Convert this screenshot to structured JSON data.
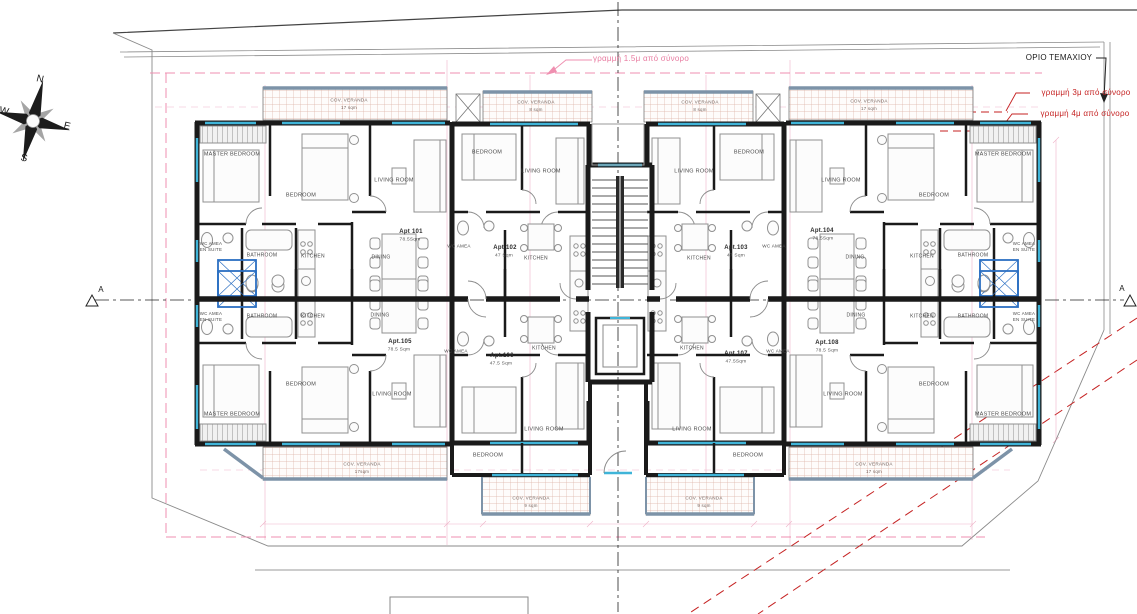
{
  "drawing_type": "architectural-floor-plan",
  "colors": {
    "wall": "#1a1a1a",
    "window": "#3fb4d8",
    "veranda_rail": "#7d93a8",
    "setback_1_5m": "#ef8fb0",
    "setback_red": "#c52222",
    "boundary_gray": "#8a8a8a",
    "construction_pink": "#e06a94"
  },
  "annotations": {
    "parcel_boundary_label": "ΟΡΙΟ ΤΕΜΑΧΙΟΥ",
    "setback_1_5m_label": "γραμμή 1.5μ από σύνορο",
    "setback_3m_label": "γραμμή 3μ από σύνορο",
    "setback_4m_label": "γραμμή 4μ από σύνορο",
    "section_marker": "A"
  },
  "compass": {
    "north": "N",
    "east": "E",
    "south": "S",
    "west": "W"
  },
  "apartments": [
    {
      "id": "Apt 101",
      "area": "78.5Sqm"
    },
    {
      "id": "Apt.102",
      "area": "47 Sqm"
    },
    {
      "id": "Apt.103",
      "area": "47 Sqm"
    },
    {
      "id": "Apt.104",
      "area": "78.5Sqm"
    },
    {
      "id": "Apt.105",
      "area": "78.5 Sqm"
    },
    {
      "id": "Apt.106",
      "area": "47.5 Sqm"
    },
    {
      "id": "Apt.107",
      "area": "47.5Sqm"
    },
    {
      "id": "Apt.108",
      "area": "78.5 Sqm"
    }
  ],
  "labels": [
    {
      "t": "MASTER BEDROOM",
      "x": 232,
      "y": 155,
      "s": 5.5,
      "c": "room",
      "n": "room-label-master-bedroom"
    },
    {
      "t": "BEDROOM",
      "x": 301,
      "y": 196,
      "s": 5.5,
      "c": "room",
      "n": "room-label-bedroom"
    },
    {
      "t": "LIVING ROOM",
      "x": 394,
      "y": 181,
      "s": 5.5,
      "c": "room",
      "n": "room-label-living-room"
    },
    {
      "t": "BATHROOM",
      "x": 262,
      "y": 256,
      "s": 5,
      "c": "room",
      "n": "room-label-bathroom"
    },
    {
      "t": "KITCHEN",
      "x": 313,
      "y": 257,
      "s": 5,
      "c": "room",
      "n": "room-label-kitchen"
    },
    {
      "t": "DINING",
      "x": 381,
      "y": 258,
      "s": 5,
      "c": "room",
      "n": "room-label-dining"
    },
    {
      "t": "WC AMEA",
      "x": 211,
      "y": 244,
      "s": 4.4,
      "c": "room",
      "n": "room-label-wc-amea"
    },
    {
      "t": "EN SUITE",
      "x": 211,
      "y": 250,
      "s": 4.4,
      "c": "room",
      "n": "room-label-en-suite"
    },
    {
      "t": "BEDROOM",
      "x": 487,
      "y": 153,
      "s": 5.5,
      "c": "room",
      "n": "room-label-bedroom"
    },
    {
      "t": "LIVING ROOM",
      "x": 541,
      "y": 172,
      "s": 5.5,
      "c": "room",
      "n": "room-label-living-room"
    },
    {
      "t": "WC AMEA",
      "x": 459,
      "y": 247,
      "s": 4.6,
      "c": "room",
      "n": "room-label-wc-amea"
    },
    {
      "t": "KITCHEN",
      "x": 536,
      "y": 259,
      "s": 5,
      "c": "room",
      "n": "room-label-kitchen"
    },
    {
      "t": "LIVING ROOM",
      "x": 694,
      "y": 172,
      "s": 5.5,
      "c": "room",
      "n": "room-label-living-room"
    },
    {
      "t": "BEDROOM",
      "x": 749,
      "y": 153,
      "s": 5.5,
      "c": "room",
      "n": "room-label-bedroom"
    },
    {
      "t": "WC AMEA",
      "x": 774,
      "y": 247,
      "s": 4.6,
      "c": "room",
      "n": "room-label-wc-amea"
    },
    {
      "t": "KITCHEN",
      "x": 699,
      "y": 259,
      "s": 5,
      "c": "room",
      "n": "room-label-kitchen"
    },
    {
      "t": "DINING",
      "x": 855,
      "y": 258,
      "s": 5,
      "c": "room",
      "n": "room-label-dining"
    },
    {
      "t": "KITCHEN",
      "x": 922,
      "y": 257,
      "s": 5,
      "c": "room",
      "n": "room-label-kitchen"
    },
    {
      "t": "BATHROOM",
      "x": 973,
      "y": 256,
      "s": 5,
      "c": "room",
      "n": "room-label-bathroom"
    },
    {
      "t": "WC AMEA",
      "x": 1024,
      "y": 244,
      "s": 4.4,
      "c": "room",
      "n": "room-label-wc-amea"
    },
    {
      "t": "EN SUITE",
      "x": 1024,
      "y": 250,
      "s": 4.4,
      "c": "room",
      "n": "room-label-en-suite"
    },
    {
      "t": "BEDROOM",
      "x": 934,
      "y": 196,
      "s": 5.5,
      "c": "room",
      "n": "room-label-bedroom"
    },
    {
      "t": "LIVING ROOM",
      "x": 841,
      "y": 181,
      "s": 5.5,
      "c": "room",
      "n": "room-label-living-room"
    },
    {
      "t": "MASTER BEDROOM",
      "x": 1003,
      "y": 155,
      "s": 5.5,
      "c": "room",
      "n": "room-label-master-bedroom"
    },
    {
      "t": "BATHROOM",
      "x": 262,
      "y": 317,
      "s": 5,
      "c": "room",
      "n": "room-label-bathroom"
    },
    {
      "t": "KITCHEN",
      "x": 313,
      "y": 317,
      "s": 5,
      "c": "room",
      "n": "room-label-kitchen"
    },
    {
      "t": "DINING",
      "x": 380,
      "y": 316,
      "s": 5,
      "c": "room",
      "n": "room-label-dining"
    },
    {
      "t": "WC AMEA",
      "x": 211,
      "y": 314,
      "s": 4.4,
      "c": "room",
      "n": "room-label-wc-amea"
    },
    {
      "t": "EN SUITE",
      "x": 211,
      "y": 320,
      "s": 4.4,
      "c": "room",
      "n": "room-label-en-suite"
    },
    {
      "t": "BEDROOM",
      "x": 301,
      "y": 385,
      "s": 5.5,
      "c": "room",
      "n": "room-label-bedroom"
    },
    {
      "t": "MASTER BEDROOM",
      "x": 232,
      "y": 415,
      "s": 5.5,
      "c": "room",
      "n": "room-label-master-bedroom"
    },
    {
      "t": "LIVING ROOM",
      "x": 392,
      "y": 395,
      "s": 5.5,
      "c": "room",
      "n": "room-label-living-room"
    },
    {
      "t": "WC AMEA",
      "x": 456,
      "y": 352,
      "s": 4.6,
      "c": "room",
      "n": "room-label-wc-amea"
    },
    {
      "t": "KITCHEN",
      "x": 544,
      "y": 349,
      "s": 5,
      "c": "room",
      "n": "room-label-kitchen"
    },
    {
      "t": "BEDROOM",
      "x": 488,
      "y": 456,
      "s": 5.5,
      "c": "room",
      "n": "room-label-bedroom"
    },
    {
      "t": "LIVING ROOM",
      "x": 544,
      "y": 430,
      "s": 5.5,
      "c": "room",
      "n": "room-label-living-room"
    },
    {
      "t": "KITCHEN",
      "x": 692,
      "y": 349,
      "s": 5,
      "c": "room",
      "n": "room-label-kitchen"
    },
    {
      "t": "WC AMEA",
      "x": 778,
      "y": 352,
      "s": 4.6,
      "c": "room",
      "n": "room-label-wc-amea"
    },
    {
      "t": "LIVING ROOM",
      "x": 692,
      "y": 430,
      "s": 5.5,
      "c": "room",
      "n": "room-label-living-room"
    },
    {
      "t": "BEDROOM",
      "x": 748,
      "y": 456,
      "s": 5.5,
      "c": "room",
      "n": "room-label-bedroom"
    },
    {
      "t": "DINING",
      "x": 856,
      "y": 316,
      "s": 5,
      "c": "room",
      "n": "room-label-dining"
    },
    {
      "t": "KITCHEN",
      "x": 922,
      "y": 317,
      "s": 5,
      "c": "room",
      "n": "room-label-kitchen"
    },
    {
      "t": "BATHROOM",
      "x": 973,
      "y": 317,
      "s": 5,
      "c": "room",
      "n": "room-label-bathroom"
    },
    {
      "t": "WC AMEA",
      "x": 1024,
      "y": 314,
      "s": 4.4,
      "c": "room",
      "n": "room-label-wc-amea"
    },
    {
      "t": "EN SUITE",
      "x": 1024,
      "y": 320,
      "s": 4.4,
      "c": "room",
      "n": "room-label-en-suite"
    },
    {
      "t": "BEDROOM",
      "x": 934,
      "y": 385,
      "s": 5.5,
      "c": "room",
      "n": "room-label-bedroom"
    },
    {
      "t": "MASTER BEDROOM",
      "x": 1003,
      "y": 415,
      "s": 5.5,
      "c": "room",
      "n": "room-label-master-bedroom"
    },
    {
      "t": "LIVING ROOM",
      "x": 843,
      "y": 395,
      "s": 5.5,
      "c": "room",
      "n": "room-label-living-room"
    },
    {
      "t": "Apt 101",
      "x": 411,
      "y": 232,
      "s": 6,
      "c": "apt",
      "n": "apt-id-101"
    },
    {
      "t": "78.5Sqm",
      "x": 410,
      "y": 241,
      "s": 4.8,
      "c": "area",
      "n": "apt-area-101"
    },
    {
      "t": "Apt.102",
      "x": 505,
      "y": 248,
      "s": 6,
      "c": "apt",
      "n": "apt-id-102"
    },
    {
      "t": "47 Sqm",
      "x": 504,
      "y": 257,
      "s": 4.8,
      "c": "area",
      "n": "apt-area-102"
    },
    {
      "t": "Apt.103",
      "x": 736,
      "y": 248,
      "s": 6,
      "c": "apt",
      "n": "apt-id-103"
    },
    {
      "t": "47 Sqm",
      "x": 736,
      "y": 257,
      "s": 4.8,
      "c": "area",
      "n": "apt-area-103"
    },
    {
      "t": "Apt.104",
      "x": 822,
      "y": 231,
      "s": 6,
      "c": "apt",
      "n": "apt-id-104"
    },
    {
      "t": "78.5Sqm",
      "x": 823,
      "y": 240,
      "s": 4.8,
      "c": "area",
      "n": "apt-area-104"
    },
    {
      "t": "Apt.105",
      "x": 400,
      "y": 342,
      "s": 6,
      "c": "apt",
      "n": "apt-id-105"
    },
    {
      "t": "78.5 Sqm",
      "x": 399,
      "y": 351,
      "s": 4.8,
      "c": "area",
      "n": "apt-area-105"
    },
    {
      "t": "Apt.106",
      "x": 502,
      "y": 356,
      "s": 6,
      "c": "apt",
      "n": "apt-id-106"
    },
    {
      "t": "47.5 Sqm",
      "x": 501,
      "y": 365,
      "s": 4.8,
      "c": "area",
      "n": "apt-area-106"
    },
    {
      "t": "Apt.107",
      "x": 736,
      "y": 354,
      "s": 6,
      "c": "apt",
      "n": "apt-id-107"
    },
    {
      "t": "47.5Sqm",
      "x": 736,
      "y": 363,
      "s": 4.8,
      "c": "area",
      "n": "apt-area-107"
    },
    {
      "t": "Apt.108",
      "x": 827,
      "y": 343,
      "s": 6,
      "c": "apt",
      "n": "apt-id-108"
    },
    {
      "t": "78.5 Sqm",
      "x": 827,
      "y": 352,
      "s": 4.8,
      "c": "area",
      "n": "apt-area-108"
    },
    {
      "t": "COV. VERANDA",
      "x": 349,
      "y": 101,
      "s": 4.6,
      "c": "ver",
      "n": "veranda-label"
    },
    {
      "t": "17 sqm",
      "x": 349,
      "y": 108,
      "s": 4.4,
      "c": "ver",
      "n": "veranda-area"
    },
    {
      "t": "COV. VERANDA",
      "x": 536,
      "y": 103,
      "s": 4.6,
      "c": "ver",
      "n": "veranda-label"
    },
    {
      "t": "8 sqm",
      "x": 536,
      "y": 110,
      "s": 4.4,
      "c": "ver",
      "n": "veranda-area"
    },
    {
      "t": "COV. VERANDA",
      "x": 700,
      "y": 103,
      "s": 4.6,
      "c": "ver",
      "n": "veranda-label"
    },
    {
      "t": "8 sqm",
      "x": 700,
      "y": 110,
      "s": 4.4,
      "c": "ver",
      "n": "veranda-area"
    },
    {
      "t": "COV. VERANDA",
      "x": 869,
      "y": 102,
      "s": 4.6,
      "c": "ver",
      "n": "veranda-label"
    },
    {
      "t": "17 sqm",
      "x": 869,
      "y": 109,
      "s": 4.4,
      "c": "ver",
      "n": "veranda-area"
    },
    {
      "t": "COV. VERANDA",
      "x": 362,
      "y": 465,
      "s": 4.6,
      "c": "ver",
      "n": "veranda-label"
    },
    {
      "t": "17sqm",
      "x": 362,
      "y": 472,
      "s": 4.4,
      "c": "ver",
      "n": "veranda-area"
    },
    {
      "t": "COV. VERANDA",
      "x": 531,
      "y": 499,
      "s": 4.6,
      "c": "ver",
      "n": "veranda-label"
    },
    {
      "t": "9 sqm",
      "x": 531,
      "y": 506,
      "s": 4.4,
      "c": "ver",
      "n": "veranda-area"
    },
    {
      "t": "COV. VERANDA",
      "x": 704,
      "y": 499,
      "s": 4.6,
      "c": "ver",
      "n": "veranda-label"
    },
    {
      "t": "9 sqm",
      "x": 704,
      "y": 506,
      "s": 4.4,
      "c": "ver",
      "n": "veranda-area"
    },
    {
      "t": "COV. VERANDA",
      "x": 874,
      "y": 465,
      "s": 4.6,
      "c": "ver",
      "n": "veranda-label"
    },
    {
      "t": "17 sqm",
      "x": 874,
      "y": 472,
      "s": 4.4,
      "c": "ver",
      "n": "veranda-area"
    },
    {
      "t": "ΟΡΙΟ ΤΕΜΑΧΙΟΥ",
      "x": 1059,
      "y": 58,
      "s": 8,
      "c": "blk",
      "n": "parcel-boundary-label"
    },
    {
      "t": "γραμμή 1.5μ από σύνορο",
      "x": 641,
      "y": 59,
      "s": 8,
      "c": "pink",
      "n": "setback-1-5m-label"
    },
    {
      "t": "γραμμή 3μ από σύνορο",
      "x": 1086,
      "y": 93,
      "s": 8,
      "c": "red",
      "n": "setback-3m-label"
    },
    {
      "t": "γραμμή 4μ από σύνορο",
      "x": 1085,
      "y": 114,
      "s": 8,
      "c": "red",
      "n": "setback-4m-label"
    },
    {
      "t": "N",
      "x": 40,
      "y": 80,
      "s": 10,
      "c": "blk",
      "r": 14,
      "n": "compass-north-label"
    },
    {
      "t": "E",
      "x": 67,
      "y": 127,
      "s": 10,
      "c": "blk",
      "r": 14,
      "n": "compass-east-label"
    },
    {
      "t": "S",
      "x": 24,
      "y": 159,
      "s": 10,
      "c": "blk",
      "r": 14,
      "n": "compass-south-label"
    },
    {
      "t": "W",
      "x": 4,
      "y": 112,
      "s": 10,
      "c": "blk",
      "r": 14,
      "n": "compass-west-label"
    },
    {
      "t": "A",
      "x": 101,
      "y": 290,
      "s": 8,
      "c": "blk",
      "n": "section-marker-label-left"
    },
    {
      "t": "A",
      "x": 1122,
      "y": 289,
      "s": 8,
      "c": "blk",
      "n": "section-marker-label-right"
    }
  ]
}
